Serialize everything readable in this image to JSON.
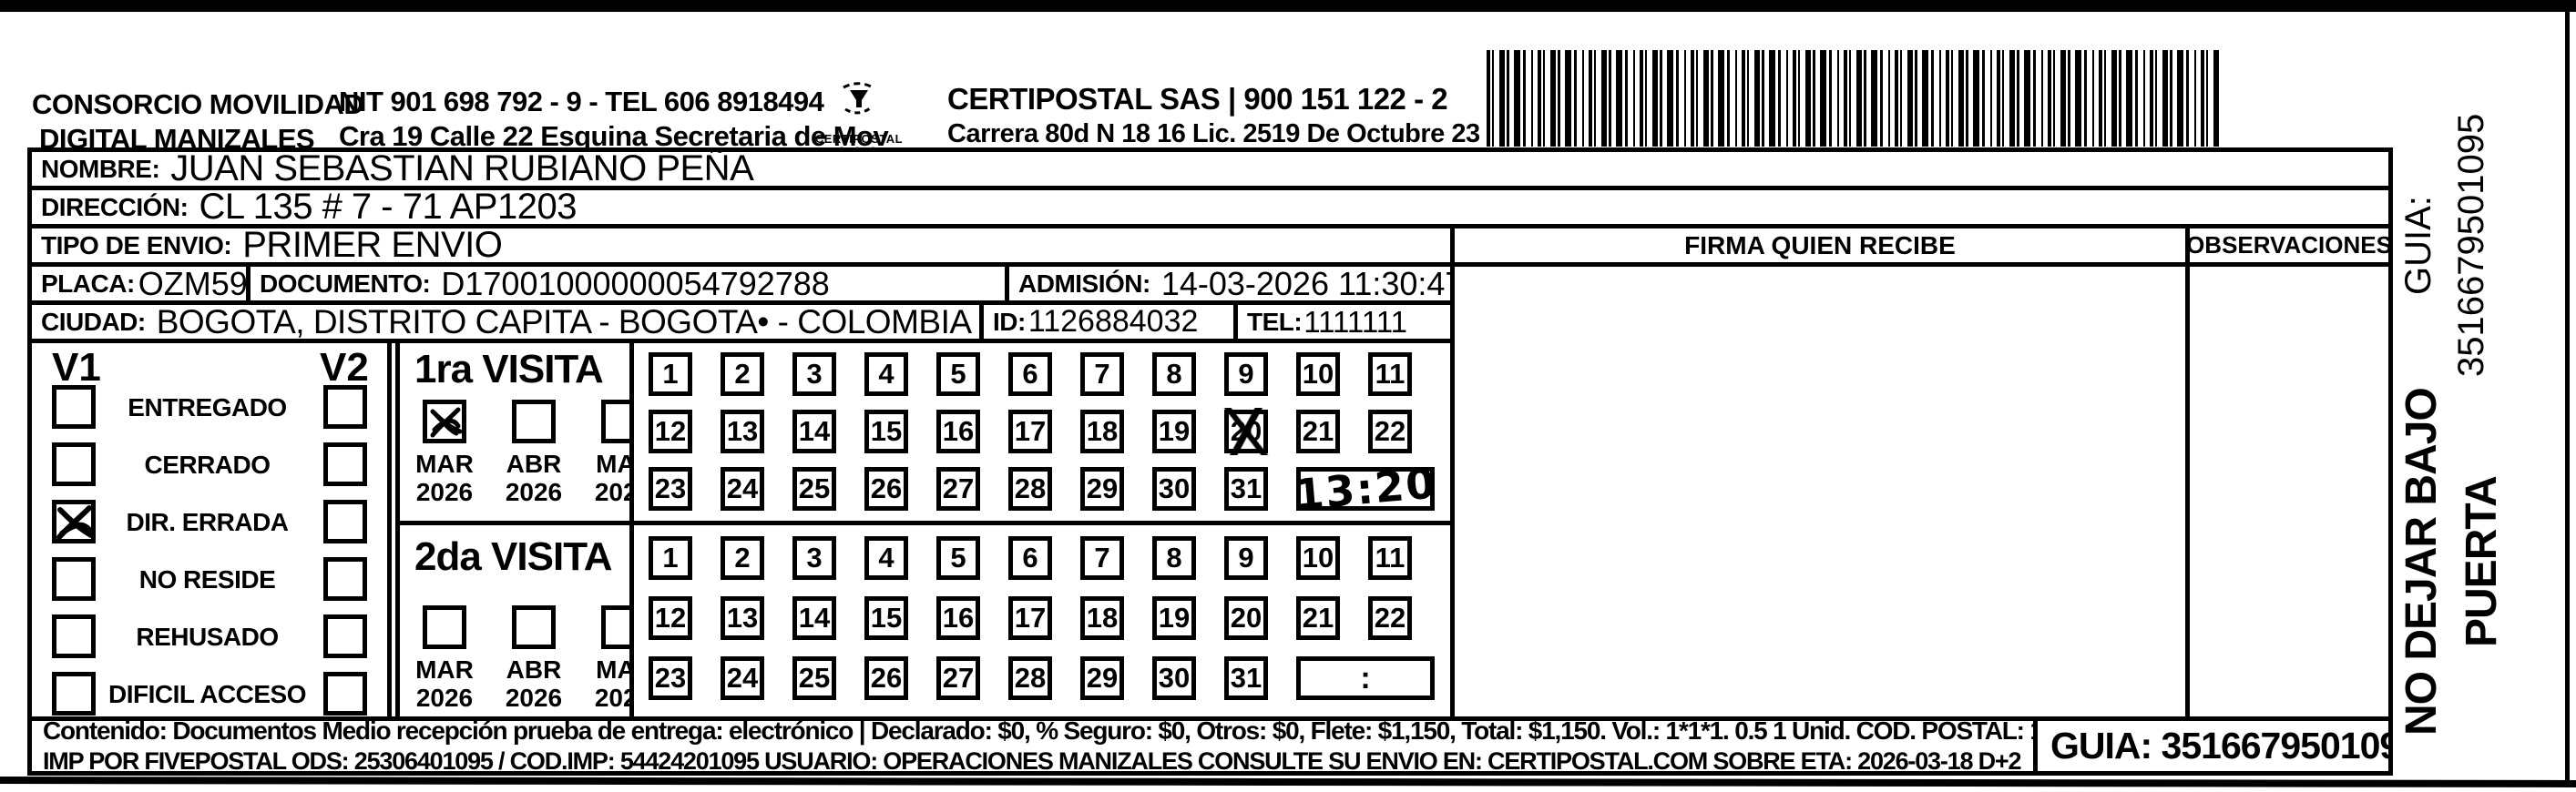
{
  "header": {
    "consorcio_line1": "CONSORCIO MOVILIDAD",
    "consorcio_line2": "DIGITAL MANIZALES",
    "nit_line1": "NIT 901 698 792 - 9 - TEL 606 8918494",
    "nit_line2": "Cra 19 Calle 22 Esquina Secretaria de Mov",
    "logo_caption": "CERTIPOSTAL",
    "certipostal_line1": "CERTIPOSTAL SAS | 900 151 122 - 2",
    "certipostal_line2": "Carrera 80d N 18 16  Lic. 2519 De Octubre 23 De 2015"
  },
  "shipment": {
    "nombre_label": "NOMBRE:",
    "nombre": "JUAN SEBASTIAN RUBIANO PEÑA",
    "direccion_label": "DIRECCIÓN:",
    "direccion": "CL 135  #  7 - 71 AP1203",
    "tipo_label": "TIPO DE ENVIO:",
    "tipo": "PRIMER ENVIO",
    "placa_label": "PLACA:",
    "placa": "OZM59F",
    "documento_label": "DOCUMENTO:",
    "documento": "D17001000000054792788",
    "admision_label": "ADMISIÓN:",
    "admision": "14-03-2026 11:30:47",
    "ciudad_label": "CIUDAD:",
    "ciudad": "BOGOTA, DISTRITO CAPITA - BOGOTA• - COLOMBIA",
    "id_label": "ID:",
    "id": "1126884032",
    "tel_label": "TEL:",
    "tel": "1111111"
  },
  "status_panel": {
    "v1_label": "V1",
    "v2_label": "V2",
    "options": [
      "ENTREGADO",
      "CERRADO",
      "DIR. ERRADA",
      "NO RESIDE",
      "REHUSADO",
      "DIFICIL ACCESO"
    ],
    "v1_checked_option": "DIR. ERRADA"
  },
  "first_visit": {
    "title": "1ra VISITA",
    "months": [
      {
        "label": "MAR",
        "year": "2026",
        "checked": true
      },
      {
        "label": "ABR",
        "year": "2026",
        "checked": false
      },
      {
        "label": "MAY",
        "year": "2026",
        "checked": false
      }
    ],
    "days": [
      "1",
      "2",
      "3",
      "4",
      "5",
      "6",
      "7",
      "8",
      "9",
      "10",
      "11",
      "12",
      "13",
      "14",
      "15",
      "16",
      "17",
      "18",
      "19",
      "20",
      "21",
      "22",
      "23",
      "24",
      "25",
      "26",
      "27",
      "28",
      "29",
      "30",
      "31"
    ],
    "crossed_day": "20",
    "time_written": "13:20"
  },
  "second_visit": {
    "title": "2da VISITA",
    "months": [
      {
        "label": "MAR",
        "year": "2026",
        "checked": false
      },
      {
        "label": "ABR",
        "year": "2026",
        "checked": false
      },
      {
        "label": "MAY",
        "year": "2026",
        "checked": false
      }
    ],
    "days": [
      "1",
      "2",
      "3",
      "4",
      "5",
      "6",
      "7",
      "8",
      "9",
      "10",
      "11",
      "12",
      "13",
      "14",
      "15",
      "16",
      "17",
      "18",
      "19",
      "20",
      "21",
      "22",
      "23",
      "24",
      "25",
      "26",
      "27",
      "28",
      "29",
      "30",
      "31"
    ],
    "time_written": ":"
  },
  "right_panel": {
    "firma_header": "FIRMA QUIEN RECIBE",
    "observaciones_header": "OBSERVACIONES"
  },
  "footer": {
    "contenido_line": "Contenido: Documentos Medio recepción prueba de entrega: electrónico | Declarado: $0, % Seguro: $0, Otros: $0, Flete: $1,150, Total: $1,150. Vol.: 1*1*1. 0.5  1 Unid. COD. POSTAL: 110121",
    "imp_line": "IMP POR FIVEPOSTAL ODS: 25306401095 / COD.IMP: 54424201095 USUARIO: OPERACIONES MANIZALES CONSULTE SU ENVIO EN: CERTIPOSTAL.COM SOBRE ETA: 2026-03-18 D+2",
    "guia": "GUIA: 3516679501095"
  },
  "side_note": {
    "line1": "NO DEJAR BAJO PUERTA",
    "line2": "GUIA: 3516679501095"
  }
}
